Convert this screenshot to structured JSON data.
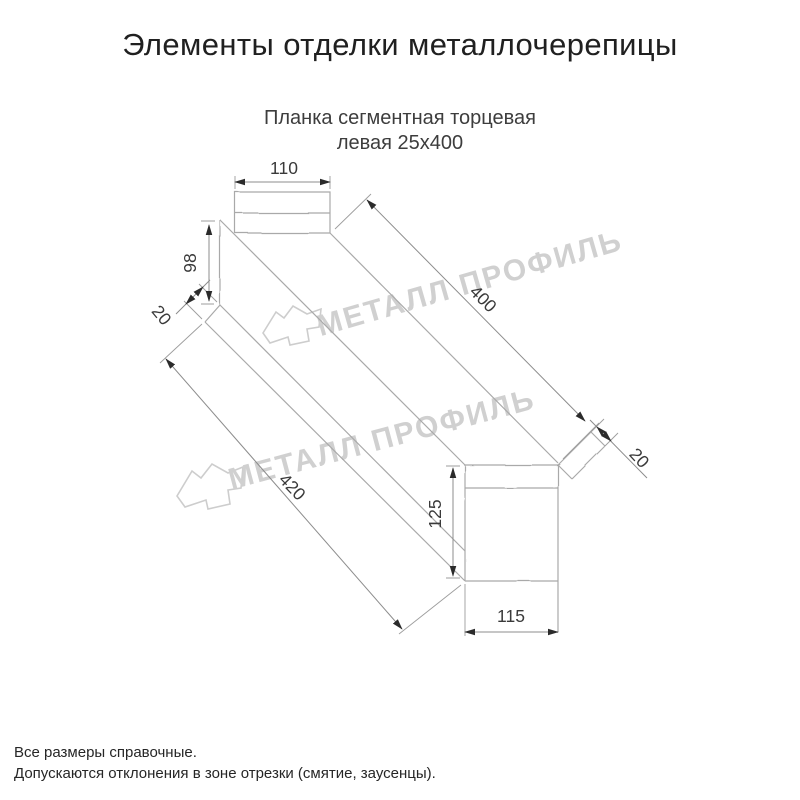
{
  "title": "Элементы отделки металлочерепицы",
  "subtitle": {
    "line1": "Планка сегментная торцевая",
    "line2": "левая 25x400"
  },
  "drawing": {
    "type": "technical-diagram",
    "part_name": "Планка сегментная торцевая левая 25x400",
    "dimensions": {
      "top_tab_width": "110",
      "left_face_height": "98",
      "left_hem": "20",
      "top_length": "400",
      "bottom_length": "420",
      "right_tab_height": "125",
      "right_tab_width": "115",
      "right_hem": "20"
    },
    "watermark": {
      "text": "МЕТАЛЛ ПРОФИЛЬ"
    },
    "colors": {
      "outline": "#a9a9a9",
      "extension_lines": "#9d9d9d",
      "dimension_lines": "#8c8c8c",
      "arrowheads": "#2b2b2b",
      "dimension_text": "#3a3a3a",
      "watermark": "#d0d0d0"
    }
  },
  "footer": {
    "line1": "Все размеры справочные.",
    "line2": "Допускаются отклонения в зоне отрезки (смятие, заусенцы)."
  }
}
